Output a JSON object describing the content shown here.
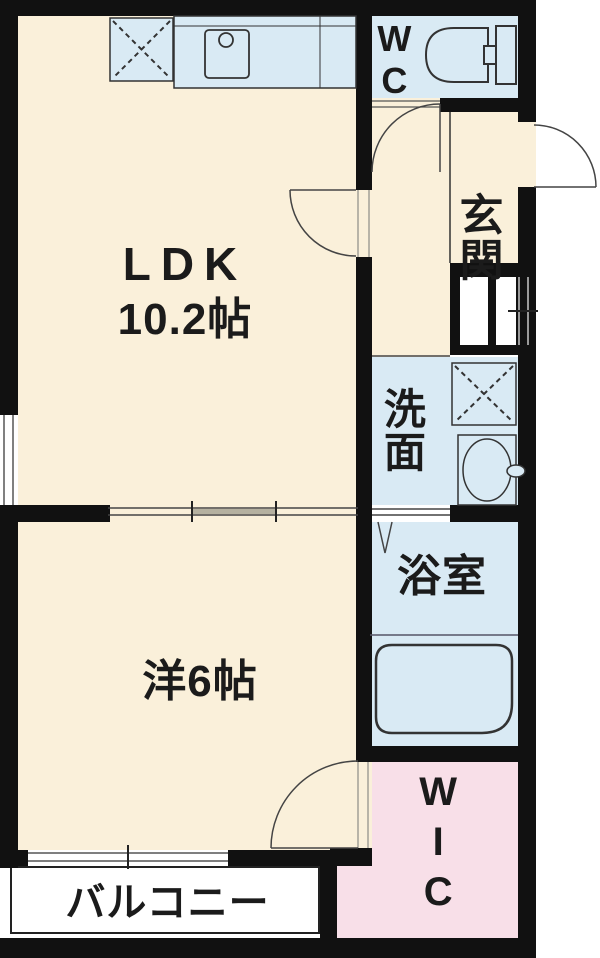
{
  "floorplan": {
    "title": "1LDK apartment floor plan",
    "rooms": {
      "ldk": {
        "label": "LDK",
        "size": "10.2帖"
      },
      "western": {
        "label": "洋6帖"
      },
      "wc": {
        "label": "WC"
      },
      "entrance": {
        "label": "玄関"
      },
      "washroom": {
        "label": "洗面"
      },
      "bathroom": {
        "label": "浴室"
      },
      "wic": {
        "label": "WIC"
      },
      "balcony": {
        "label": "バルコニー"
      }
    },
    "colors": {
      "room_cream": "#faf0da",
      "water_blue": "#d9eaf4",
      "closet_pink": "#f8dfe8",
      "wall_black": "#111111",
      "fixture_outline": "#333333",
      "window_gray": "#999999"
    },
    "fixtures": [
      "refrigerator-space",
      "kitchen-counter",
      "kitchen-sink",
      "toilet",
      "washing-machine-space",
      "washbasin",
      "bathtub",
      "entrance-door-swing",
      "wc-door-swing",
      "ldk-door-swing",
      "wic-door-swing",
      "sliding-door",
      "window"
    ]
  }
}
